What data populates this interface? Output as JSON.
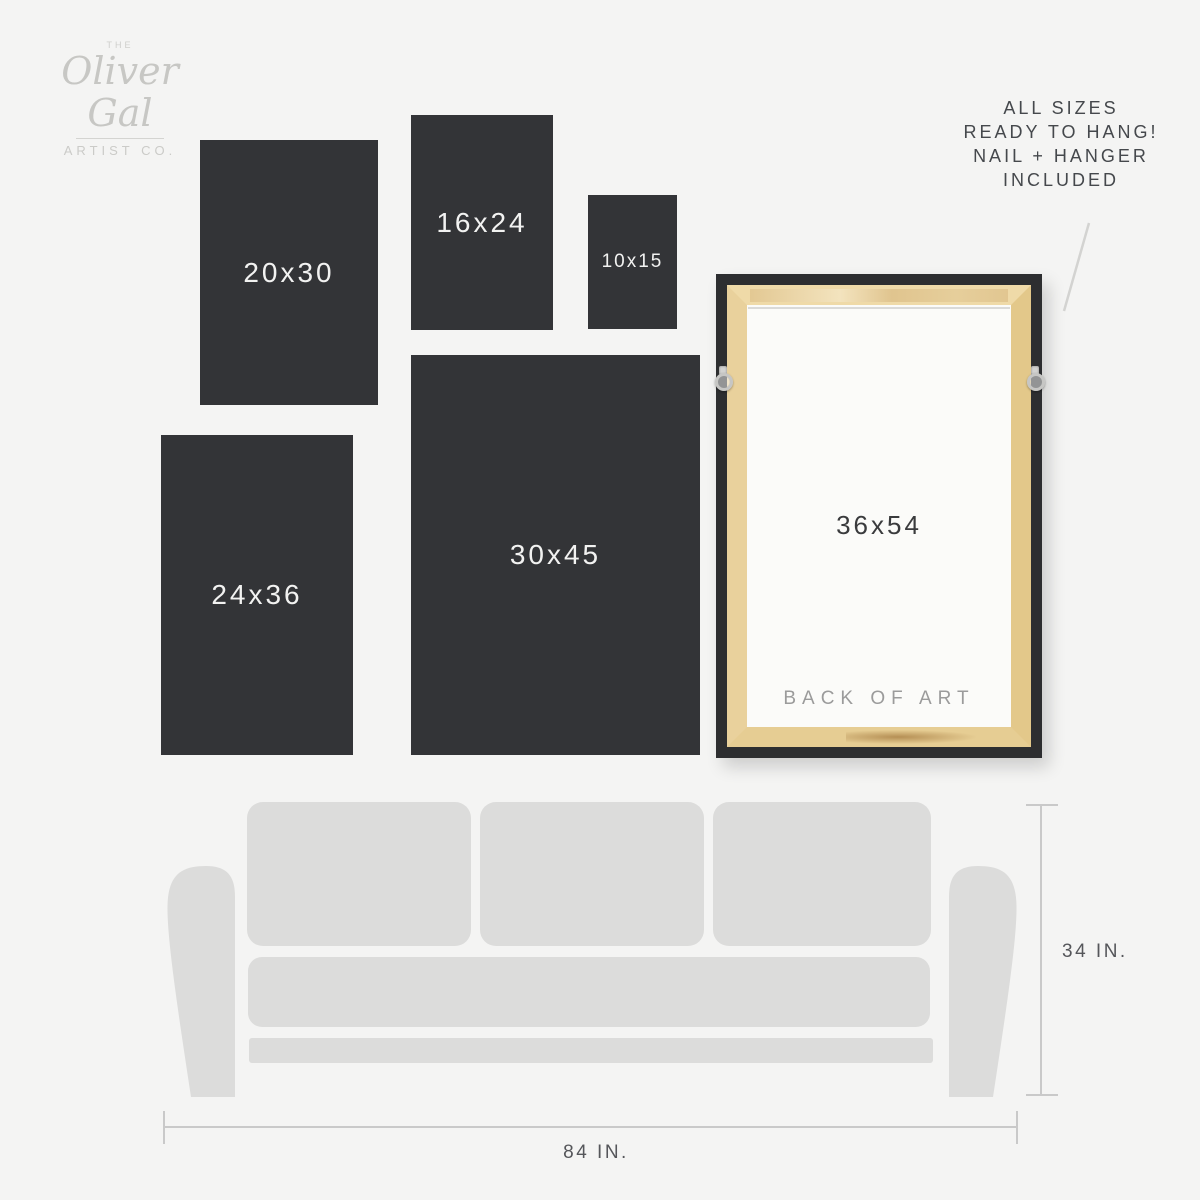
{
  "brand": {
    "the": "THE",
    "name": "Oliver Gal",
    "subtitle": "ARTIST CO."
  },
  "header_note": {
    "lines": [
      "ALL SIZES",
      "READY TO HANG!",
      "NAIL + HANGER",
      "INCLUDED"
    ]
  },
  "sizes": [
    {
      "label": "20x30"
    },
    {
      "label": "16x24"
    },
    {
      "label": "10x15"
    },
    {
      "label": "24x36"
    },
    {
      "label": "30x45"
    }
  ],
  "frame": {
    "size_label": "36x54",
    "back_label": "BACK OF ART"
  },
  "dimensions": {
    "couch_height": "34 IN.",
    "couch_width": "84 IN."
  },
  "colors": {
    "background": "#f4f4f3",
    "panel_dark": "#333437",
    "panel_text": "#f2f2f1",
    "couch": "#dcdcdb",
    "wood": "#e8cf97",
    "frame_black": "#2d2e30",
    "dim_line": "#c9c9c9",
    "dim_text": "#55565a",
    "note_text": "#45484c",
    "logo_gray": "#c9c9c6",
    "back_label_gray": "#9b9b9b"
  }
}
